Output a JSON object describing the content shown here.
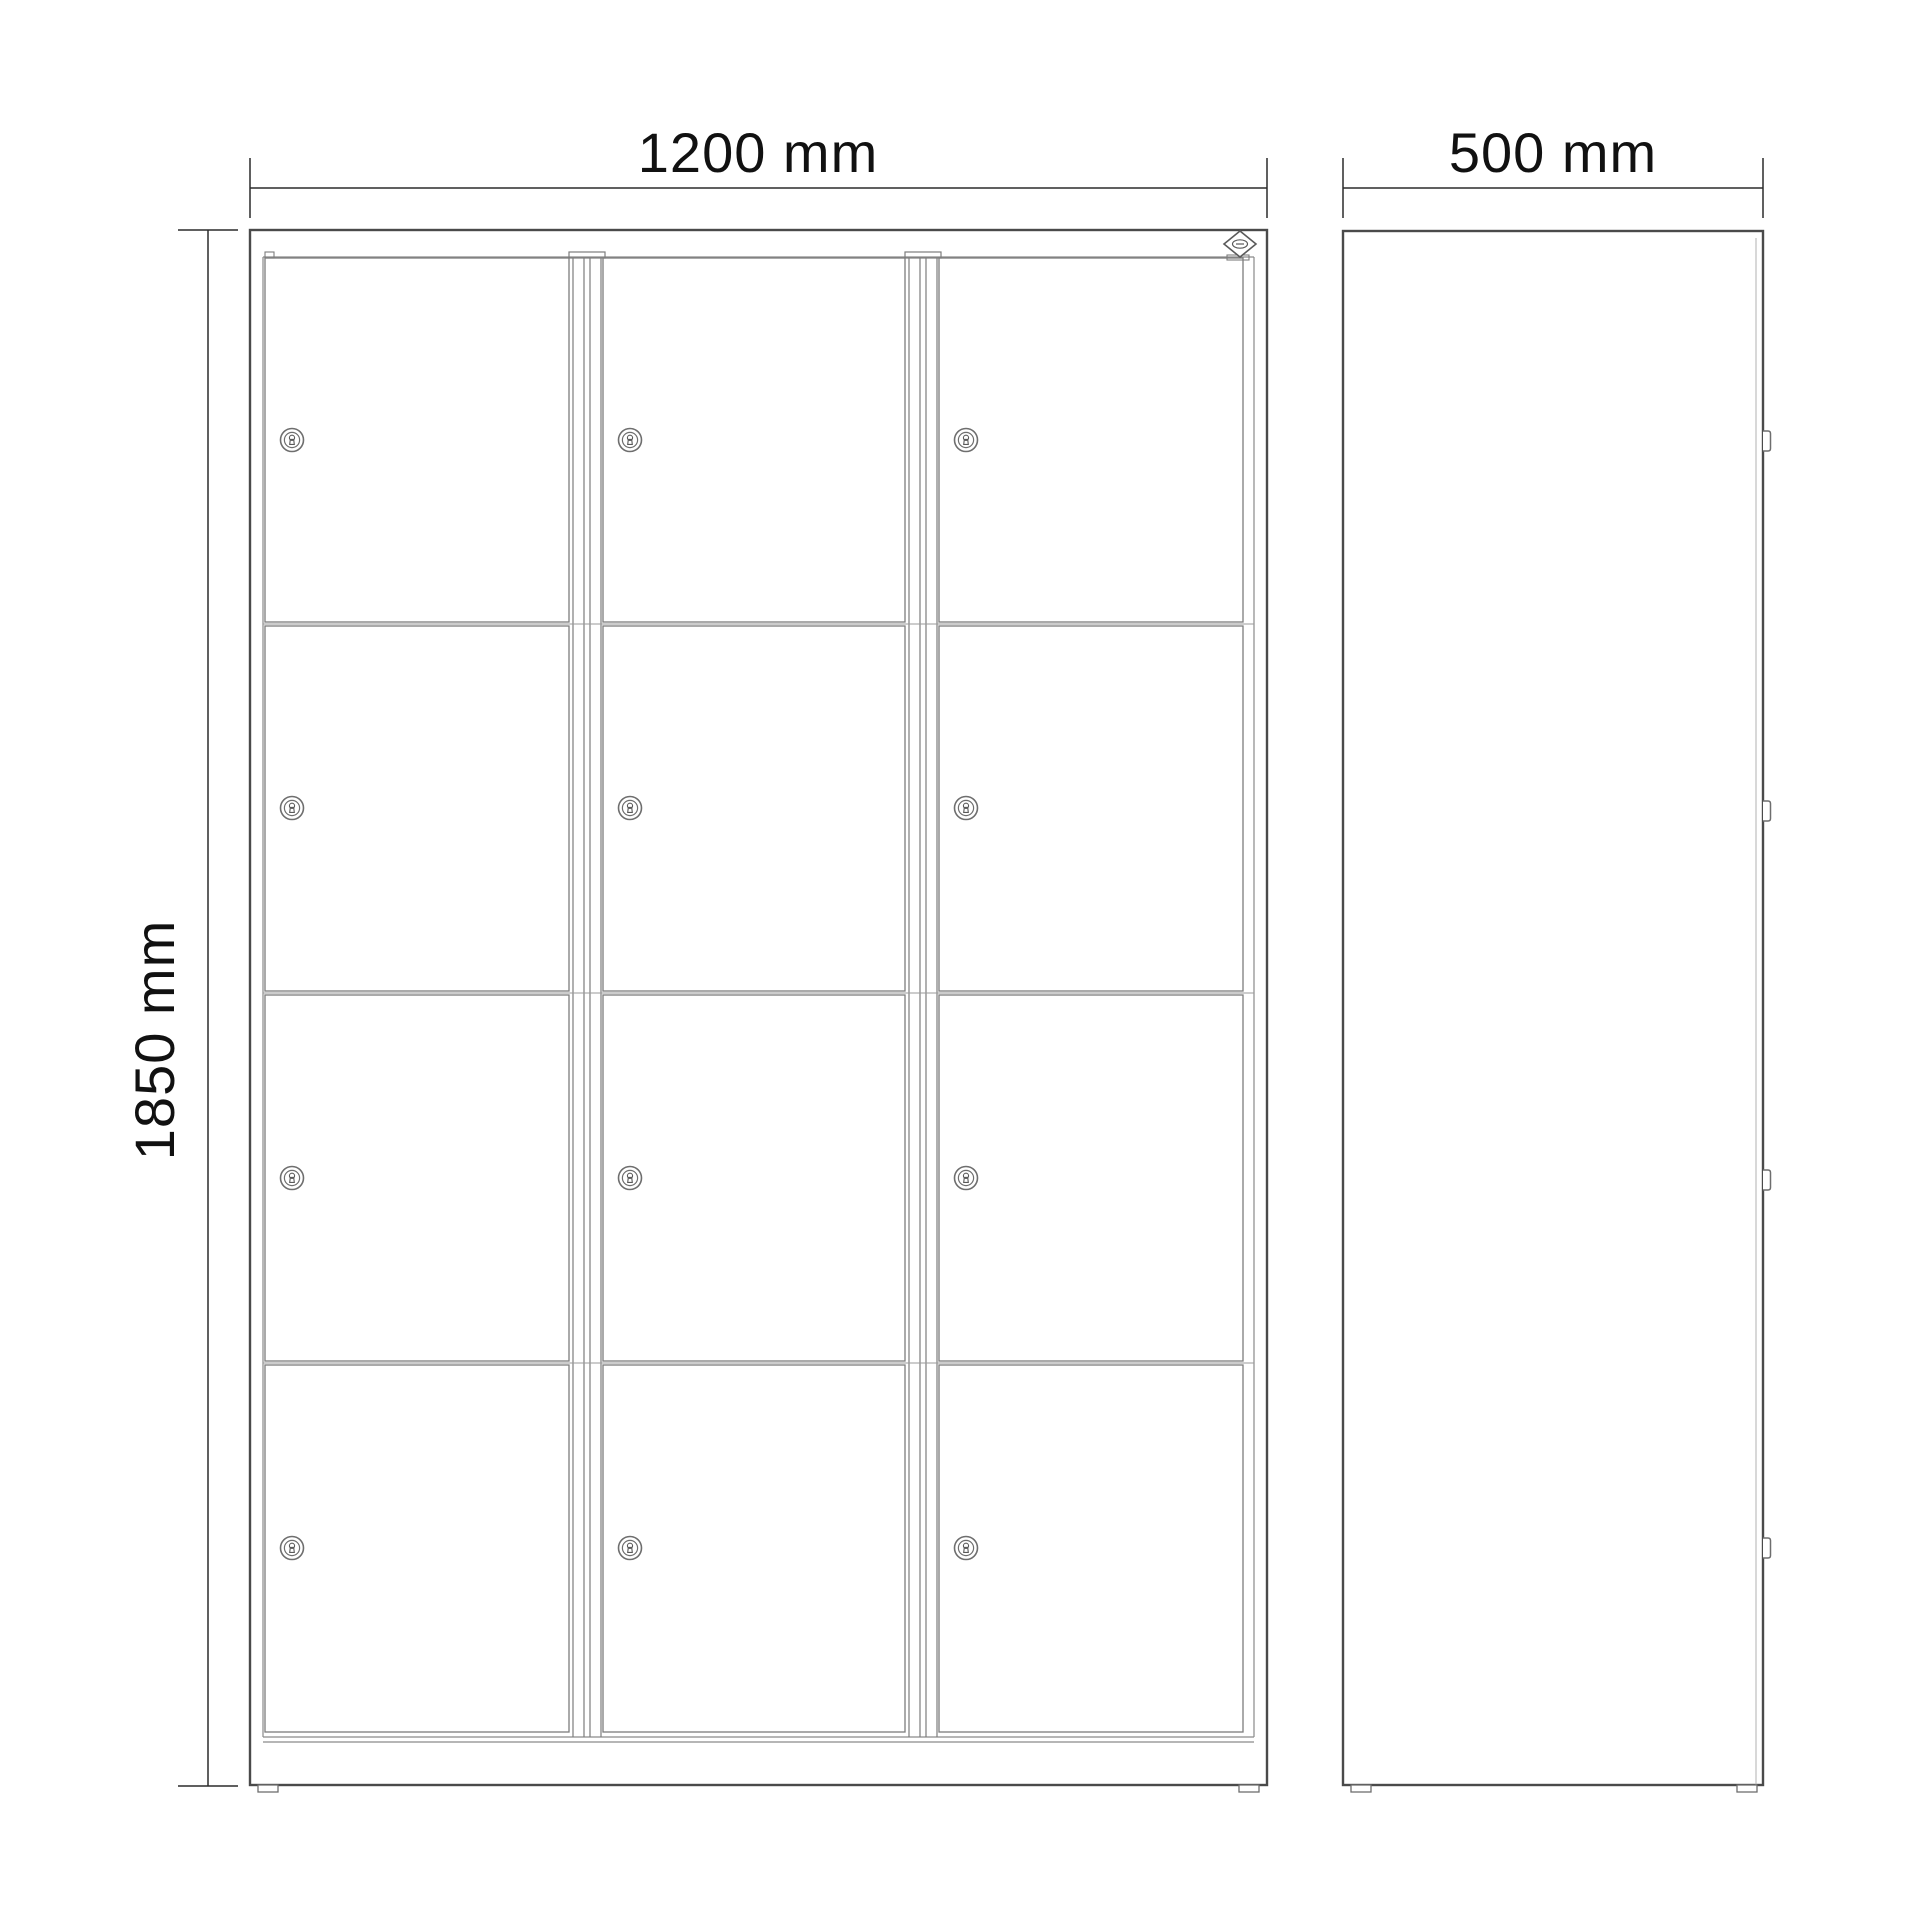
{
  "drawing": {
    "title": "locker cabinet technical drawing",
    "views": {
      "front": {
        "name": "front-view",
        "door_columns": 3,
        "door_rows": 4,
        "compartments": 12,
        "locks_visible": 12,
        "feet_visible": 2
      },
      "side": {
        "name": "side-view",
        "hinges_visible": 4,
        "feet_visible": 2
      }
    },
    "dimensions": {
      "width": {
        "label": "1200 mm",
        "applies_to": "front-view"
      },
      "height": {
        "label": "1850 mm",
        "applies_to": "front-view"
      },
      "depth": {
        "label": "500 mm",
        "applies_to": "side-view"
      }
    },
    "icons": {
      "lock": "cylinder-lock-keyhole-icon",
      "hinge": "door-hinge-icon",
      "logo": "brand-diamond-logo-icon"
    },
    "colors": {
      "background": "#ffffff",
      "outline": "#4a4a4a",
      "panel_line": "#7d7d7d",
      "detail_line": "#9a9a9a",
      "dimension_line": "#2b2b2b",
      "text": "#111111"
    }
  }
}
